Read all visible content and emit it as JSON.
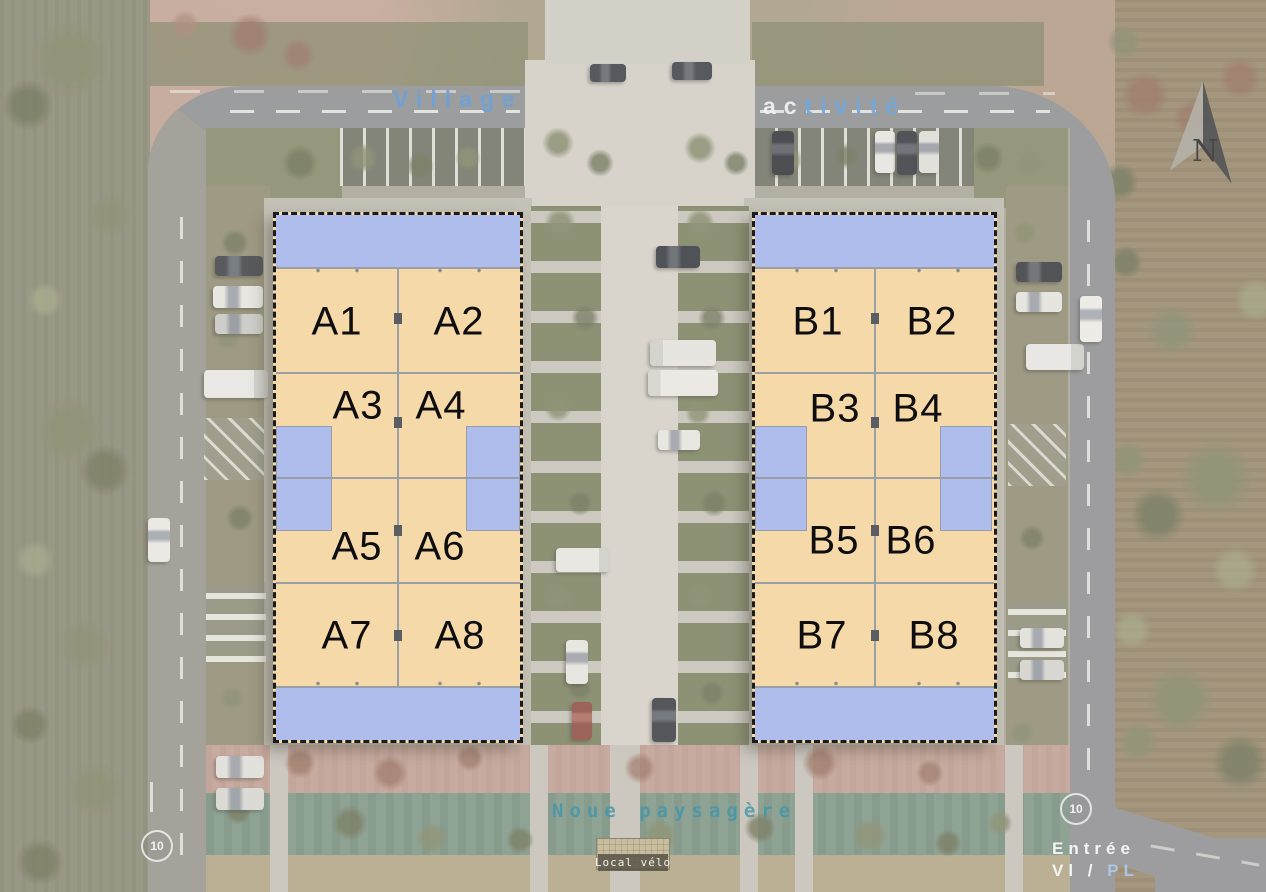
{
  "scene": {
    "title": {
      "village": "Village",
      "activite_white": "ac",
      "activite_blue": "tivité"
    },
    "compass_label": "N",
    "speed_markings": {
      "left": "10",
      "right": "10"
    },
    "landscape_label": "Noue paysagère",
    "bike_shed_label": "Local vélo",
    "entrance": {
      "line1": "Entrée",
      "line2_a": "Vl /",
      "line2_b": "PL"
    }
  },
  "buildings": {
    "a": {
      "units": [
        "A1",
        "A2",
        "A3",
        "A4",
        "A5",
        "A6",
        "A7",
        "A8"
      ]
    },
    "b": {
      "units": [
        "B1",
        "B2",
        "B3",
        "B4",
        "B5",
        "B6",
        "B7",
        "B8"
      ]
    }
  },
  "colors": {
    "unit_fill": "#f6d9a9",
    "mezzanine_fill": "#aebdec",
    "road_text_blue": "#74a4d8",
    "noue_text_teal": "#4e9cb0",
    "road_gray": "#8c8f93"
  }
}
